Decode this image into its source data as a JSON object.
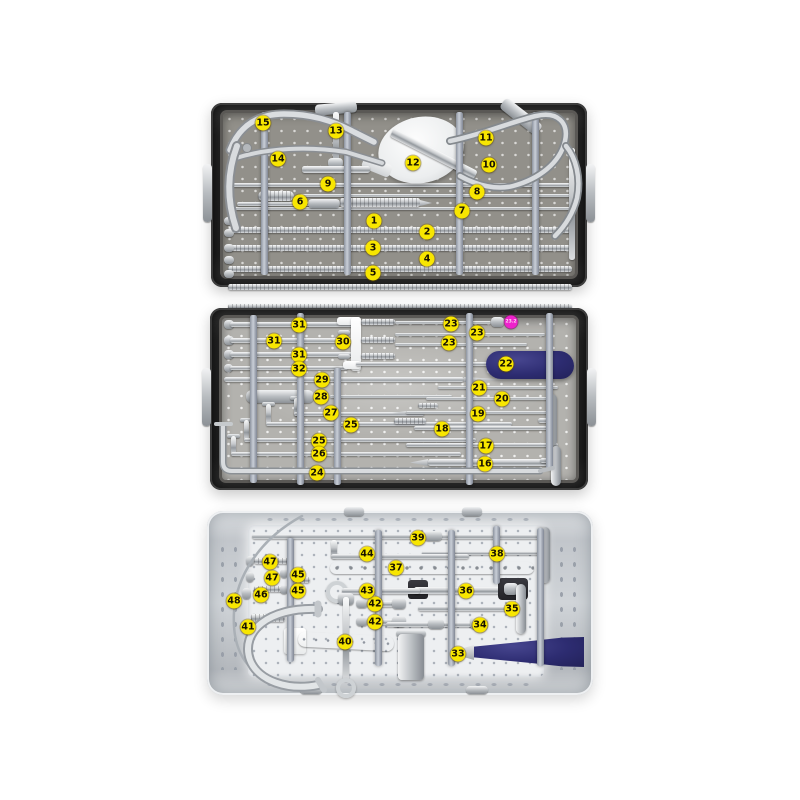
{
  "figure": {
    "type": "annotated-photo",
    "subject": "surgical instrument sterilization trays with numbered instruments"
  },
  "colors": {
    "page_background": "#ffffff",
    "badge_yellow": "#f8e600",
    "badge_text": "#171100",
    "highlight_pink": "#ee22cc",
    "tray_case_dark": "#262626",
    "tray1_floor": "#92908a",
    "tray2_floor": "#b3b2ae",
    "tray3_floor": "#edeff1",
    "handle_navy": "#2d2c71"
  },
  "trays": [
    {
      "id": "top",
      "labels": [
        {
          "text": "1",
          "x": 374,
          "y": 221
        },
        {
          "text": "2",
          "x": 427,
          "y": 232
        },
        {
          "text": "3",
          "x": 373,
          "y": 248
        },
        {
          "text": "4",
          "x": 427,
          "y": 259
        },
        {
          "text": "5",
          "x": 373,
          "y": 273
        },
        {
          "text": "6",
          "x": 300,
          "y": 202
        },
        {
          "text": "7",
          "x": 462,
          "y": 211
        },
        {
          "text": "8",
          "x": 477,
          "y": 192
        },
        {
          "text": "9",
          "x": 328,
          "y": 184
        },
        {
          "text": "10",
          "x": 489,
          "y": 165
        },
        {
          "text": "11",
          "x": 486,
          "y": 138
        },
        {
          "text": "12",
          "x": 413,
          "y": 163
        },
        {
          "text": "13",
          "x": 336,
          "y": 131
        },
        {
          "text": "14",
          "x": 278,
          "y": 159
        },
        {
          "text": "15",
          "x": 263,
          "y": 123
        }
      ]
    },
    {
      "id": "middle",
      "labels": [
        {
          "text": "16",
          "x": 485,
          "y": 464
        },
        {
          "text": "17",
          "x": 486,
          "y": 446
        },
        {
          "text": "18",
          "x": 442,
          "y": 429
        },
        {
          "text": "19",
          "x": 478,
          "y": 414
        },
        {
          "text": "20",
          "x": 502,
          "y": 399
        },
        {
          "text": "21",
          "x": 479,
          "y": 388
        },
        {
          "text": "22",
          "x": 506,
          "y": 364
        },
        {
          "text": "23",
          "x": 451,
          "y": 324
        },
        {
          "text": "23",
          "x": 477,
          "y": 333
        },
        {
          "text": "23",
          "x": 449,
          "y": 343
        },
        {
          "text": "23.2",
          "x": 511,
          "y": 322,
          "style": "pink"
        },
        {
          "text": "24",
          "x": 317,
          "y": 473
        },
        {
          "text": "25",
          "x": 351,
          "y": 425
        },
        {
          "text": "25",
          "x": 319,
          "y": 441
        },
        {
          "text": "26",
          "x": 319,
          "y": 454
        },
        {
          "text": "27",
          "x": 331,
          "y": 413
        },
        {
          "text": "28",
          "x": 321,
          "y": 397
        },
        {
          "text": "29",
          "x": 322,
          "y": 380
        },
        {
          "text": "30",
          "x": 343,
          "y": 342
        },
        {
          "text": "31",
          "x": 299,
          "y": 325
        },
        {
          "text": "31",
          "x": 274,
          "y": 341
        },
        {
          "text": "31",
          "x": 299,
          "y": 355
        },
        {
          "text": "32",
          "x": 299,
          "y": 369
        }
      ]
    },
    {
      "id": "bottom",
      "labels": [
        {
          "text": "33",
          "x": 458,
          "y": 654
        },
        {
          "text": "34",
          "x": 480,
          "y": 625
        },
        {
          "text": "35",
          "x": 512,
          "y": 609
        },
        {
          "text": "36",
          "x": 466,
          "y": 591
        },
        {
          "text": "37",
          "x": 396,
          "y": 568
        },
        {
          "text": "38",
          "x": 497,
          "y": 554
        },
        {
          "text": "39",
          "x": 418,
          "y": 538
        },
        {
          "text": "40",
          "x": 345,
          "y": 642
        },
        {
          "text": "41",
          "x": 248,
          "y": 627
        },
        {
          "text": "42",
          "x": 375,
          "y": 604
        },
        {
          "text": "42",
          "x": 375,
          "y": 622
        },
        {
          "text": "43",
          "x": 367,
          "y": 591
        },
        {
          "text": "44",
          "x": 367,
          "y": 554
        },
        {
          "text": "45",
          "x": 298,
          "y": 575
        },
        {
          "text": "45",
          "x": 298,
          "y": 591
        },
        {
          "text": "46",
          "x": 261,
          "y": 595
        },
        {
          "text": "47",
          "x": 270,
          "y": 562
        },
        {
          "text": "47",
          "x": 272,
          "y": 578
        },
        {
          "text": "48",
          "x": 234,
          "y": 601
        }
      ]
    }
  ]
}
